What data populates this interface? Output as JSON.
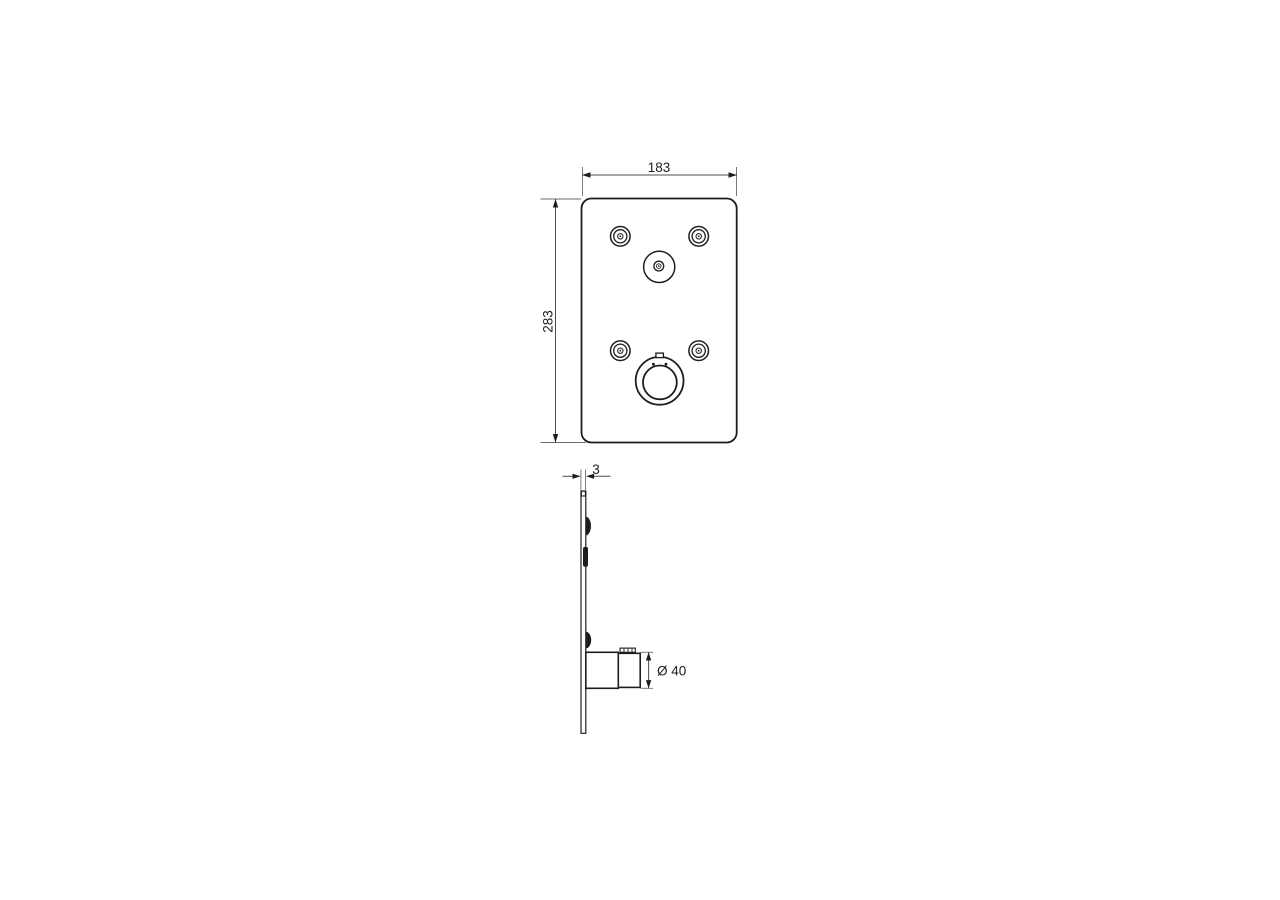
{
  "drawing": {
    "title": "faceplate-technical-drawing",
    "colors": {
      "background": "#ffffff",
      "outline": "#1d1d1b",
      "dimension": "#4d4d4d"
    },
    "front": {
      "width_label": "183",
      "height_label": "283"
    },
    "side": {
      "thickness_label": "3",
      "knob_diameter_label": "Ø 40"
    }
  }
}
